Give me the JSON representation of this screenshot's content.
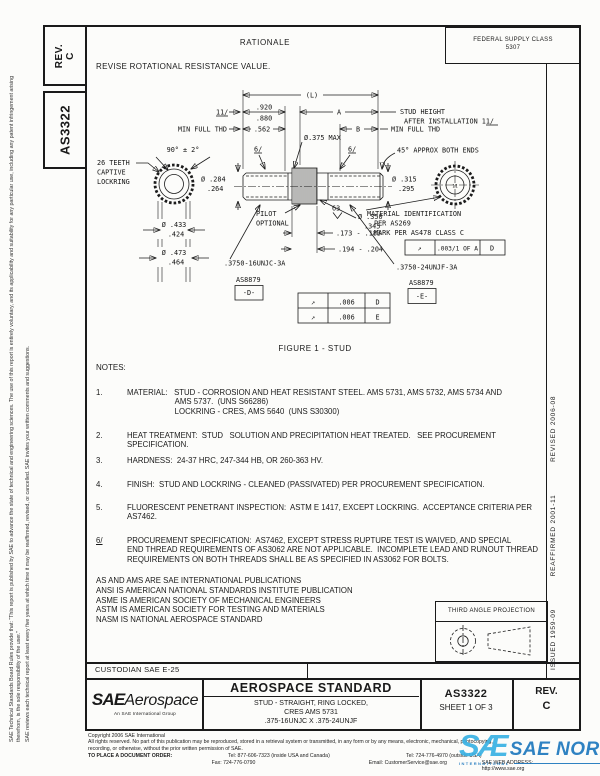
{
  "doc": {
    "rev_label": "REV.",
    "rev_value": "C",
    "number": "AS3322",
    "fsc_line1": "FEDERAL SUPPLY CLASS",
    "fsc_line2": "5307",
    "rationale_title": "RATIONALE",
    "rationale_text": "REVISE ROTATIONAL RESISTANCE VALUE."
  },
  "margins": {
    "left_col1": "SAE Technical Standards Board Rules provide that: “This report is published by SAE to advance the state of technical and engineering sciences. The use of this report is entirely voluntary, and its applicability and suitability for any particular use, including any patent infringement arising therefrom, is the sole responsibility of the user.”",
    "left_col2": "SAE reviews each technical report at least every five years at which time it may be reaffirmed, revised, or cancelled. SAE invites your written comments and suggestions.",
    "issued": "ISSUED 1959-09",
    "reaffirmed": "REAFFIRMED 2001-11",
    "revised": "REVISED 2006-08"
  },
  "figure": {
    "caption": "FIGURE 1 - STUD",
    "labels": {
      "dim_L": "(L)",
      "flag_11": "11/",
      "dim_920": ".920",
      "dim_880": ".880",
      "dim_A": "A",
      "stud_height_1": "STUD HEIGHT",
      "stud_height_2": "AFTER INSTALLATION  11/",
      "min_full_thd_left": "MIN FULL THD",
      "dim_562": ".562",
      "dim_B": "B",
      "min_full_thd_right": "MIN FULL THD",
      "dia_375_max": "Ø.375 MAX",
      "angle_90": "90° ± 2°",
      "teeth_line1": "26 TEETH",
      "teeth_line2": "CAPTIVE",
      "teeth_line3": "LOCKRING",
      "flag_6_left": "6/",
      "flag_6_right": "6/",
      "chamfer_45": "45° APPROX BOTH ENDS",
      "dia_284": "Ø .284",
      "dia_264": ".264",
      "dia_315": "Ø .315",
      "dia_295": ".295",
      "pilot_line1": "PILOT",
      "pilot_line2": "OPTIONAL",
      "finish_63": "63",
      "dia_350": "Ø .350",
      "dia_345": ".345",
      "dim_173": ".173 - .183",
      "dim_194": ".194 - .204",
      "dia_433": "Ø .433",
      "dia_424": ".424",
      "dia_473": "Ø .473",
      "dia_464": ".464",
      "thread_left": ".3750-16UNJC-3A",
      "thread_right": ".3750-24UNJF-3A",
      "as8879_left": "AS8879",
      "datum_d": "-D-",
      "as8879_right": "AS8879",
      "datum_e": "-E-",
      "end_mark": "11",
      "material_id_1": "MATERIAL IDENTIFICATION",
      "material_id_2": "PER AS269",
      "material_id_3": "MARK PER AS478 CLASS C",
      "fcf_main_sym": "↗",
      "fcf_main_val": ".003/1 OF A",
      "fcf_main_datum": "D",
      "fcf_r1_sym": "↗",
      "fcf_r1_val": ".006",
      "fcf_r1_datum": "D",
      "fcf_r2_sym": "↗",
      "fcf_r2_val": ".006",
      "fcf_r2_datum": "E"
    }
  },
  "notes": {
    "heading": "NOTES:",
    "items": [
      {
        "num": "1.",
        "text": "MATERIAL:   STUD - CORROSION AND HEAT RESISTANT STEEL. AMS 5731, AMS 5732, AMS 5734 AND\n                      AMS 5737.  (UNS S66286)\n                      LOCKRING - CRES, AMS 5640  (UNS S30300)"
      },
      {
        "num": "2.",
        "text": "HEAT TREATMENT:  STUD   SOLUTION AND PRECIPITATION HEAT TREATED.   SEE PROCUREMENT\nSPECIFICATION."
      },
      {
        "num": "3.",
        "text": "HARDNESS:  24-37 HRC, 247-344 HB, OR 260-363 HV."
      },
      {
        "num": "4.",
        "text": "FINISH:  STUD AND LOCKRING - CLEANED (PASSIVATED) PER PROCUREMENT SPECIFICATION."
      },
      {
        "num": "5.",
        "text": "FLUORESCENT PENETRANT INSPECTION:  ASTM E 1417, EXCEPT LOCKRING.  ACCEPTANCE CRITERIA PER\nAS7462."
      },
      {
        "num": "6/",
        "text": "PROCUREMENT SPECIFICATION:  AS7462, EXCEPT STRESS RUPTURE TEST IS WAIVED, AND SPECIAL\nEND THREAD REQUIREMENTS OF AS3062 ARE NOT APPLICABLE.  INCOMPLETE LEAD AND RUNOUT THREAD\nREQUIREMENTS ON BOTH THREADS SHALL BE AS SPECIFIED IN AS3062 FOR BOLTS."
      }
    ]
  },
  "publications": [
    "AS AND AMS ARE SAE INTERNATIONAL PUBLICATIONS",
    "ANSI IS AMERICAN NATIONAL STANDARDS INSTITUTE PUBLICATION",
    "ASME IS AMERICAN SOCIETY OF MECHANICAL ENGINEERS",
    "ASTM IS AMERICAN SOCIETY FOR TESTING AND MATERIALS",
    "NASM IS NATIONAL AEROSPACE STANDARD"
  ],
  "projection": {
    "title": "THIRD ANGLE PROJECTION"
  },
  "custodian": {
    "label": "CUSTODIAN  SAE E-25"
  },
  "title_block": {
    "logo_main": "SAE",
    "logo_secondary": "Aerospace",
    "logo_tagline": "An SAE International Group",
    "title": "AEROSPACE STANDARD",
    "subtitle1": "STUD - STRAIGHT, RING LOCKED,",
    "subtitle2": "CRES AMS 5731",
    "subtitle3": ".375-16UNJC X .375-24UNJF",
    "number": "AS3322",
    "sheet": "SHEET 1 OF 3",
    "rev_label": "REV.",
    "rev_value": "C"
  },
  "footer": {
    "copyright": "Copyright 2006 SAE International",
    "rights1": "All rights reserved. No part of this publication may be reproduced, stored in a retrieval system or transmitted, in any form or by any means, electronic, mechanical, photocopying,",
    "rights2": "recording, or otherwise, without the prior written permission of SAE.",
    "order_label": "TO PLACE A DOCUMENT ORDER:",
    "tel_inside": "Tel: 877-606-7323 (inside USA and Canada)",
    "tel_outside": "Tel: 724-776-4970 (outside USA)",
    "fax": "Fax: 724-776-0790",
    "email": "Email: CustomerService@sae.org",
    "web": "SAE WEB ADDRESS: http://www.sae.org"
  },
  "watermark": {
    "logo": "SÆ",
    "text": "SAE NORM",
    "tagline": "INTERNATIONAL",
    "color_light": "#39b2e4",
    "color_dark": "#1e78be"
  }
}
